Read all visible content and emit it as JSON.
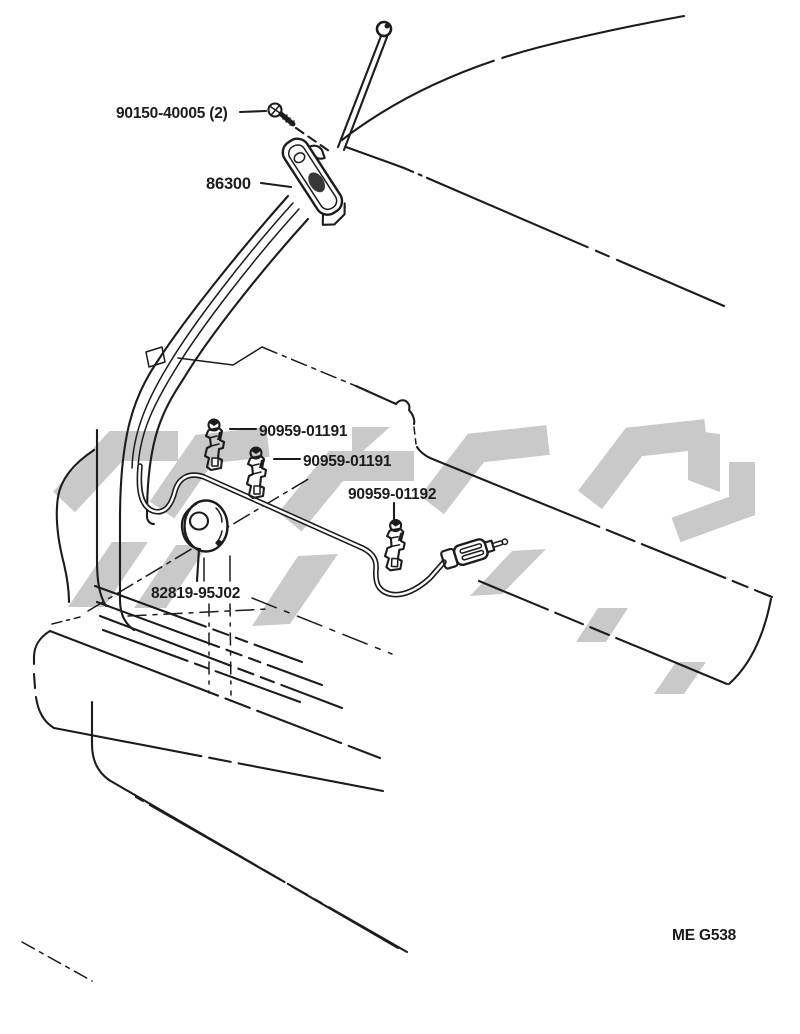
{
  "figure": {
    "code": "ME G538"
  },
  "parts": {
    "screw": {
      "label": "90150-40005 (2)"
    },
    "antenna_assembly": {
      "label": "86300"
    },
    "clamp_a": {
      "label": "90959-01191"
    },
    "clamp_b": {
      "label": "90959-01191"
    },
    "clamp_c": {
      "label": "90959-01192"
    },
    "grommet": {
      "label": "82819-95J02"
    }
  },
  "colors": {
    "line": "#1c1c1c",
    "watermark": "#c9c9c9",
    "background": "#ffffff"
  }
}
